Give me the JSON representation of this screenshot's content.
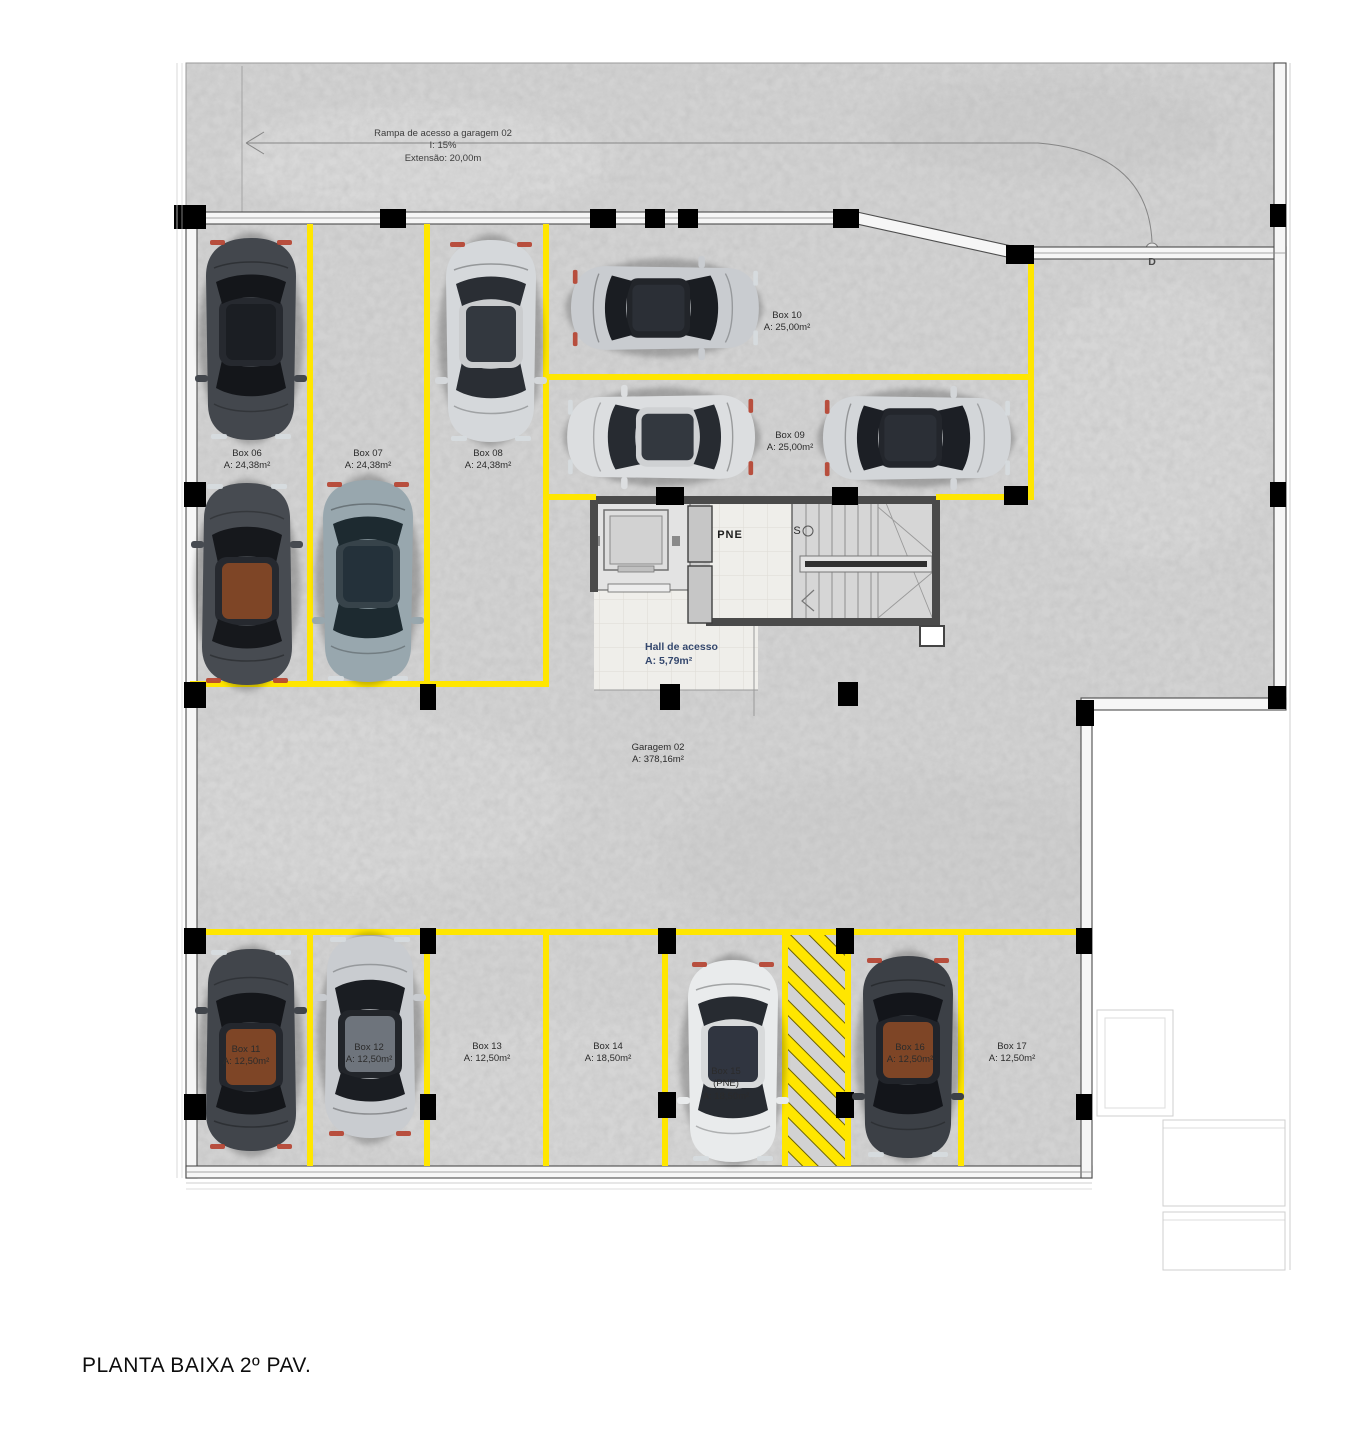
{
  "title": "PLANTA BAIXA 2º PAV.",
  "ramp": {
    "name": "Rampa de acesso a garagem 02",
    "slope": "I: 15%",
    "length": "Extensão: 20,00m"
  },
  "markers": {
    "door": "D",
    "stairs_start": "S",
    "pne_room": "PNE"
  },
  "hall": {
    "name": "Hall de acesso",
    "area": "A: 5,79m²"
  },
  "garage": {
    "name": "Garagem 02",
    "area": "A: 378,16m²"
  },
  "boxes": [
    {
      "name": "Box 06",
      "area": "A: 24,38m²"
    },
    {
      "name": "Box 07",
      "area": "A: 24,38m²"
    },
    {
      "name": "Box 08",
      "area": "A: 24,38m²"
    },
    {
      "name": "Box 09",
      "area": "A: 25,00m²"
    },
    {
      "name": "Box 10",
      "area": "A: 25,00m²"
    },
    {
      "name": "Box 11",
      "area": "A: 12,50m²"
    },
    {
      "name": "Box 12",
      "area": "A: 12,50m²"
    },
    {
      "name": "Box 13",
      "area": "A: 12,50m²"
    },
    {
      "name": "Box 14",
      "area": "A: 18,50m²"
    },
    {
      "name": "Box 15",
      "note": "(PNE)",
      "area": "A: 18,50m²"
    },
    {
      "name": "Box 16",
      "area": "A: 12,50m²"
    },
    {
      "name": "Box 17",
      "area": "A: 12,50m²"
    }
  ],
  "colors": {
    "line-yellow": "#ffe600",
    "concrete": "#d2d2d2",
    "wall-dark": "#4a4a4a",
    "column-black": "#000000",
    "hall-label-blue": "#35486e",
    "tile": "#efeeea"
  }
}
